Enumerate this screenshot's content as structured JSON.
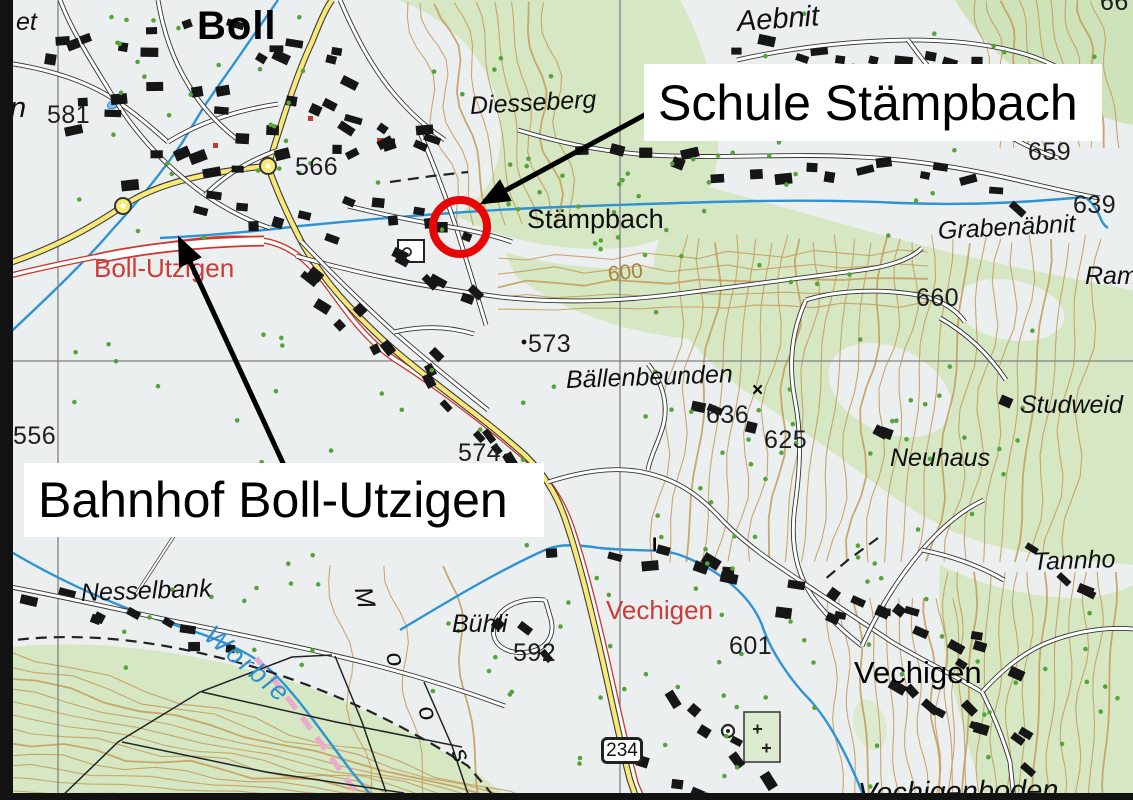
{
  "annotations": {
    "school_label": "Schule Stämpbach",
    "station_label": "Bahnhof Boll-Utzigen",
    "circle_color": "#e60606",
    "arrow_color": "#000000",
    "box_bg": "#ffffff"
  },
  "road_shield": {
    "number": "234"
  },
  "colors": {
    "paper": "#eceff0",
    "forest_green": "#d6e7c4",
    "contour_brown": "#c49a58",
    "stream_blue": "#2e93d5",
    "road_yellow": "#f8e878",
    "rail_red": "#cc372c",
    "red_label": "#cc3b35",
    "grid_gray": "#808080",
    "building_black": "#161616",
    "tree_green": "#55a339",
    "boundary_pink": "#eaaccb"
  },
  "map_labels": [
    {
      "id": "et",
      "text": "et",
      "x": 16,
      "y": 10,
      "cls": "field",
      "rot": 0
    },
    {
      "id": "boll",
      "text": "Boll",
      "x": 197,
      "y": 6,
      "cls": "town-lg",
      "rot": 0
    },
    {
      "id": "n-fragment",
      "text": "n",
      "x": 10,
      "y": 94,
      "cls": "field-lg",
      "rot": 0
    },
    {
      "id": "elev-581",
      "text": "581",
      "x": 47,
      "y": 103,
      "cls": "num",
      "rot": 0
    },
    {
      "id": "elev-566",
      "text": "566",
      "x": 295,
      "y": 155,
      "cls": "num",
      "rot": 0
    },
    {
      "id": "diesseberg",
      "text": "Diesseberg",
      "x": 470,
      "y": 94,
      "cls": "field",
      "rot": -3
    },
    {
      "id": "aebnit",
      "text": "Aebnit",
      "x": 737,
      "y": 8,
      "cls": "field-lg",
      "rot": -4
    },
    {
      "id": "elev-659",
      "text": "659",
      "x": 1028,
      "y": 140,
      "cls": "num",
      "rot": 0
    },
    {
      "id": "stampbach",
      "text": "Stämpbach",
      "x": 527,
      "y": 206,
      "cls": "town",
      "rot": 0
    },
    {
      "id": "elev-639",
      "text": "639",
      "x": 1073,
      "y": 193,
      "cls": "num",
      "rot": 0
    },
    {
      "id": "grabenabnit",
      "text": "Grabenäbnit",
      "x": 938,
      "y": 219,
      "cls": "field",
      "rot": -3
    },
    {
      "id": "ram-fragment",
      "text": "Ram",
      "x": 1085,
      "y": 264,
      "cls": "field",
      "rot": 0
    },
    {
      "id": "boll-utzigen",
      "text": "Boll-Utzigen",
      "x": 94,
      "y": 255,
      "cls": "red",
      "rot": 0
    },
    {
      "id": "contour-600",
      "text": "600",
      "x": 608,
      "y": 264,
      "cls": "contour-lbl",
      "rot": -6
    },
    {
      "id": "elev-660",
      "text": "660",
      "x": 916,
      "y": 286,
      "cls": "num",
      "rot": 0
    },
    {
      "id": "elev-556-a",
      "text": "556",
      "x": 13,
      "y": 424,
      "cls": "num",
      "rot": 0
    },
    {
      "id": "elev-573",
      "text": "573",
      "x": 528,
      "y": 332,
      "cls": "num",
      "rot": 0
    },
    {
      "id": "ballenbeunden",
      "text": "Bällenbeunden",
      "x": 566,
      "y": 368,
      "cls": "field",
      "rot": -2
    },
    {
      "id": "elev-636",
      "text": "636",
      "x": 706,
      "y": 403,
      "cls": "num",
      "rot": 0
    },
    {
      "id": "elev-625",
      "text": "625",
      "x": 764,
      "y": 428,
      "cls": "num",
      "rot": 0
    },
    {
      "id": "studweid",
      "text": "Studweid",
      "x": 1020,
      "y": 393,
      "cls": "field",
      "rot": 0
    },
    {
      "id": "elev-574",
      "text": "574",
      "x": 458,
      "y": 441,
      "cls": "num",
      "rot": 0
    },
    {
      "id": "neuhaus",
      "text": "Neuhaus",
      "x": 890,
      "y": 446,
      "cls": "field",
      "rot": 0
    },
    {
      "id": "nesselbank",
      "text": "Nesselbank",
      "x": 81,
      "y": 581,
      "cls": "field",
      "rot": -2
    },
    {
      "id": "worble",
      "text": "Worble",
      "x": 208,
      "y": 618,
      "cls": "river",
      "rot": 40
    },
    {
      "id": "moos-m",
      "text": "M",
      "x": 362,
      "y": 575,
      "cls": "field",
      "rot": 78
    },
    {
      "id": "moos-o1",
      "text": "o",
      "x": 393,
      "y": 640,
      "cls": "field",
      "rot": 75
    },
    {
      "id": "moos-o2",
      "text": "o",
      "x": 425,
      "y": 694,
      "cls": "field",
      "rot": 72
    },
    {
      "id": "moos-s",
      "text": "s",
      "x": 458,
      "y": 737,
      "cls": "field",
      "rot": 68
    },
    {
      "id": "tannho",
      "text": "Tannho",
      "x": 1033,
      "y": 550,
      "cls": "field",
      "rot": -2
    },
    {
      "id": "buhli",
      "text": "Bühli",
      "x": 452,
      "y": 612,
      "cls": "field",
      "rot": 0
    },
    {
      "id": "elev-592",
      "text": "592",
      "x": 513,
      "y": 641,
      "cls": "num",
      "rot": 0
    },
    {
      "id": "vechigen-red",
      "text": "Vechigen",
      "x": 606,
      "y": 597,
      "cls": "red",
      "rot": 0
    },
    {
      "id": "elev-601",
      "text": "601",
      "x": 729,
      "y": 634,
      "cls": "num",
      "rot": 0
    },
    {
      "id": "vechigen-town",
      "text": "Vechigen",
      "x": 854,
      "y": 657,
      "cls": "town-lg2",
      "rot": 0
    },
    {
      "id": "vechigenboden",
      "text": "Vechigenboden",
      "x": 858,
      "y": 780,
      "cls": "field-lg",
      "rot": -1
    },
    {
      "id": "elev-66",
      "text": "66",
      "x": 1100,
      "y": -10,
      "cls": "num",
      "rot": 0
    },
    {
      "id": "x-mark",
      "text": "×",
      "x": 752,
      "y": 381,
      "cls": "sym",
      "rot": 0
    },
    {
      "id": "i-mark",
      "text": "I",
      "x": 652,
      "y": 536,
      "cls": "sym",
      "rot": 0
    }
  ]
}
